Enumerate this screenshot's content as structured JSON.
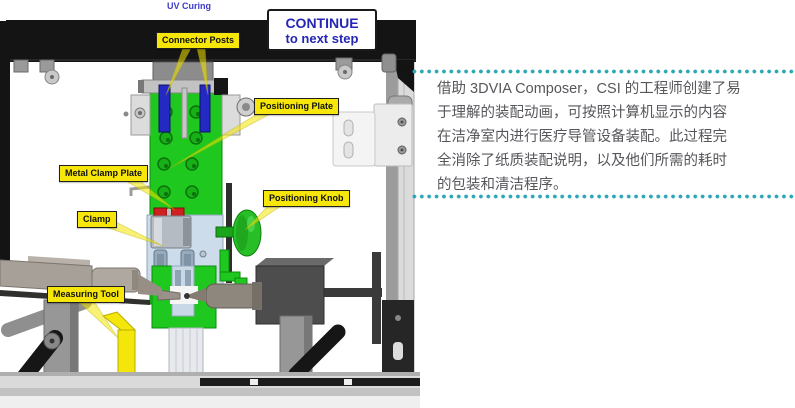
{
  "scene": {
    "station_title": "UV Curing",
    "continue_button": {
      "line1": "CONTINUE",
      "line2": "to next step"
    },
    "callouts": [
      {
        "id": "connector-posts",
        "label": "Connector Posts"
      },
      {
        "id": "positioning-plate",
        "label": "Positioning Plate"
      },
      {
        "id": "metal-clamp-plate",
        "label": "Metal Clamp Plate"
      },
      {
        "id": "clamp",
        "label": "Clamp"
      },
      {
        "id": "positioning-knob",
        "label": "Positioning Knob"
      },
      {
        "id": "measuring-tool",
        "label": "Measuring Tool"
      }
    ],
    "colors": {
      "callout_yellow": "#f6e60a",
      "button_text_blue": "#2527b4",
      "station_title_blue": "#3b3bcb",
      "machine_green": "#1fc81f",
      "connector_post_blue": "#2529c4",
      "clamp_red": "#ce2020",
      "frame_black": "#141414",
      "gauge_yellow": "#f4e60a"
    }
  },
  "text_panel": {
    "accent_color": "#2ba7b5",
    "text_color": "#56575b",
    "lines": [
      "借助 3DVIA Composer，CSI 的工程师创建了易",
      "于理解的装配动画，可按照计算机显示的内容",
      "在洁净室内进行医疗导管设备装配。此过程完",
      "全消除了纸质装配说明，以及他们所需的耗时",
      "的包装和清洁程序。"
    ],
    "full_text": "借助 3DVIA Composer，CSI 的工程师创建了易于理解的装配动画，可按照计算机显示的内容在洁净室内进行医疗导管设备装配。此过程完全消除了纸质装配说明，以及他们所需的耗时的包装和清洁程序。"
  }
}
